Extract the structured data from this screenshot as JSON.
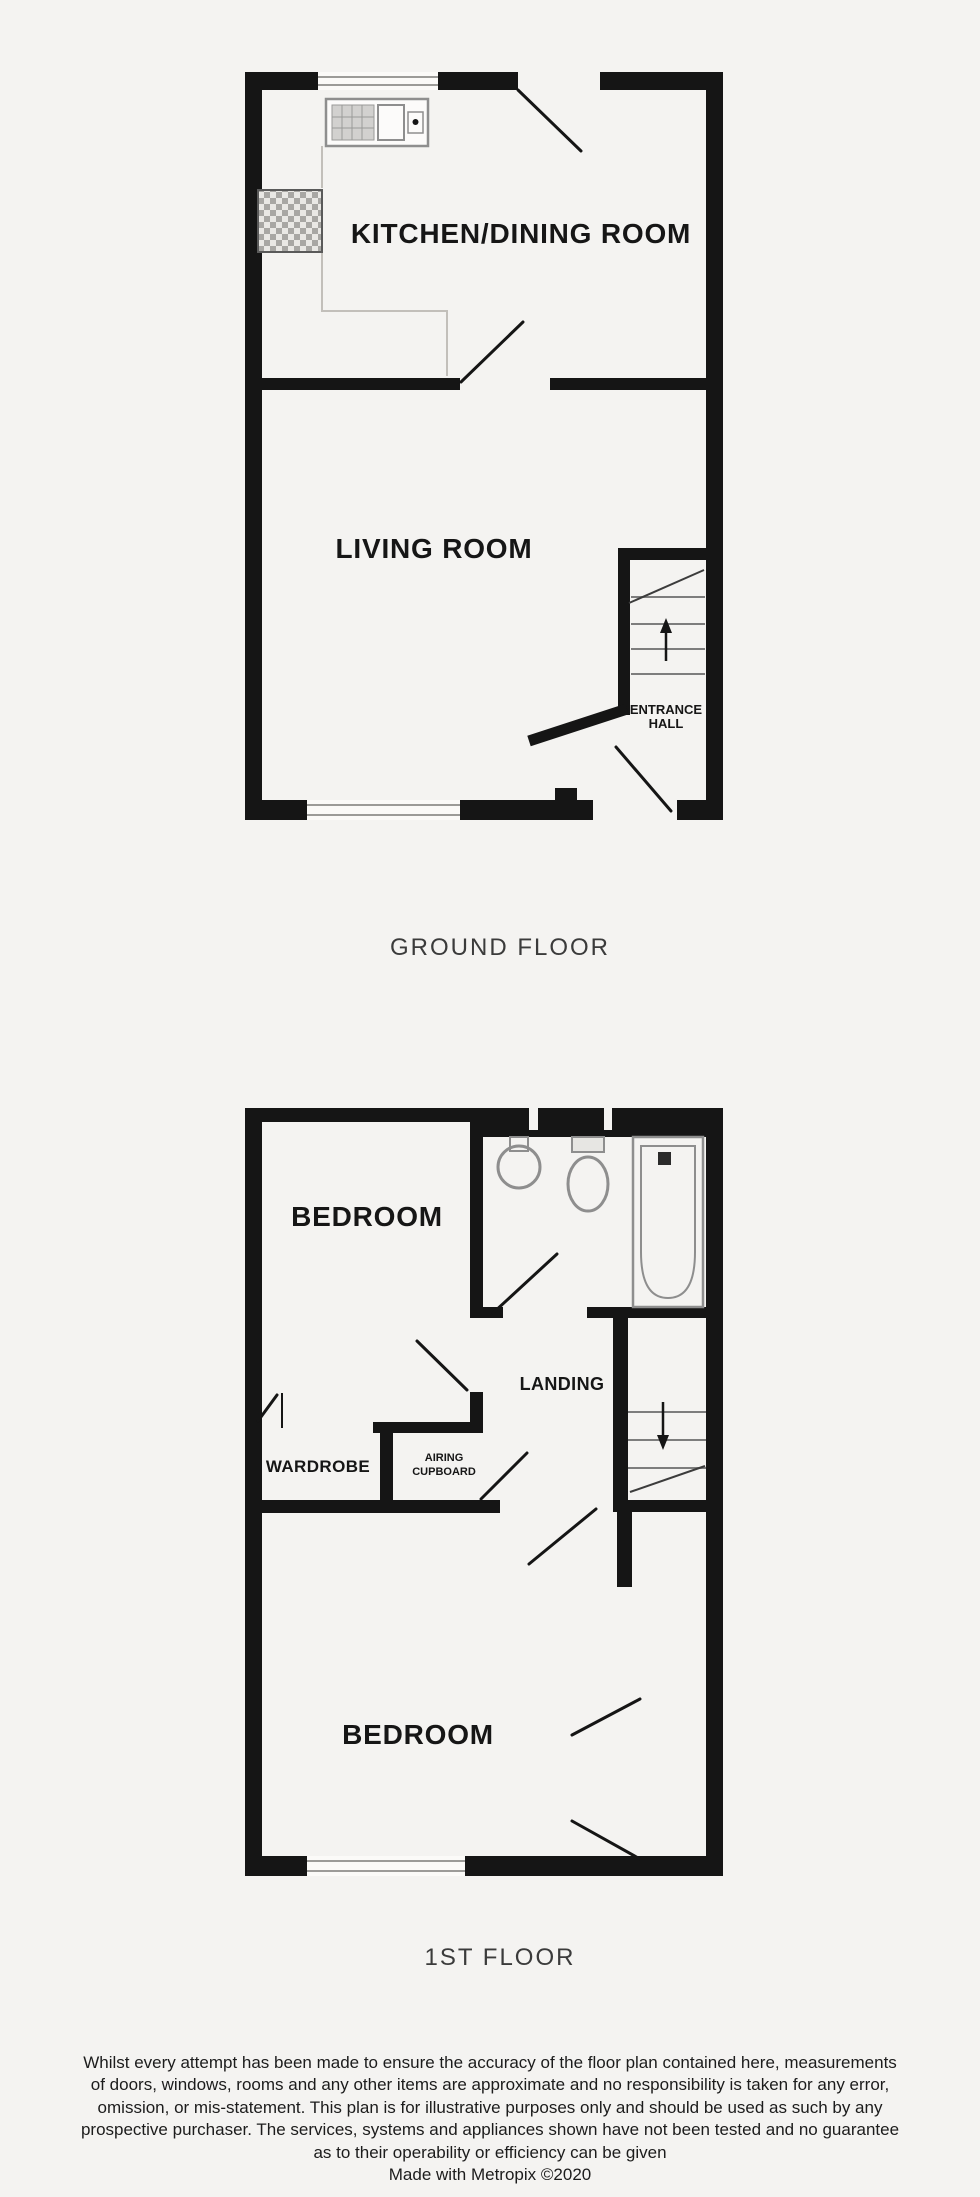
{
  "ground_floor": {
    "caption": "GROUND FLOOR",
    "labels": {
      "kitchen": "KITCHEN/DINING ROOM",
      "living": "LIVING ROOM",
      "entrance_hall_line1": "ENTRANCE",
      "entrance_hall_line2": "HALL"
    }
  },
  "first_floor": {
    "caption": "1ST FLOOR",
    "labels": {
      "bedroom_front": "BEDROOM",
      "bedroom_back": "BEDROOM",
      "landing": "LANDING",
      "wardrobe": "WARDROBE",
      "airing_cupboard_line1": "AIRING",
      "airing_cupboard_line2": "CUPBOARD"
    }
  },
  "disclaimer": {
    "lines": [
      "Whilst every attempt has been made to ensure the accuracy of the floor plan contained here, measurements",
      "of doors, windows, rooms and any other items are approximate and no responsibility is taken for any error,",
      "omission, or mis-statement. This plan is for illustrative purposes only and should be used as such by any",
      "prospective purchaser. The services, systems and appliances shown have not been tested and no guarantee",
      "as to their operability or efficiency can be given",
      "Made with Metropix ©2020"
    ]
  },
  "colors": {
    "background": "#f4f3f1",
    "wall": "#151515",
    "fixture": "#8e8e8e",
    "label": "#161616",
    "caption": "#3b3b3b",
    "faint": "#c2bfba",
    "tread": "#7d7d7d"
  }
}
